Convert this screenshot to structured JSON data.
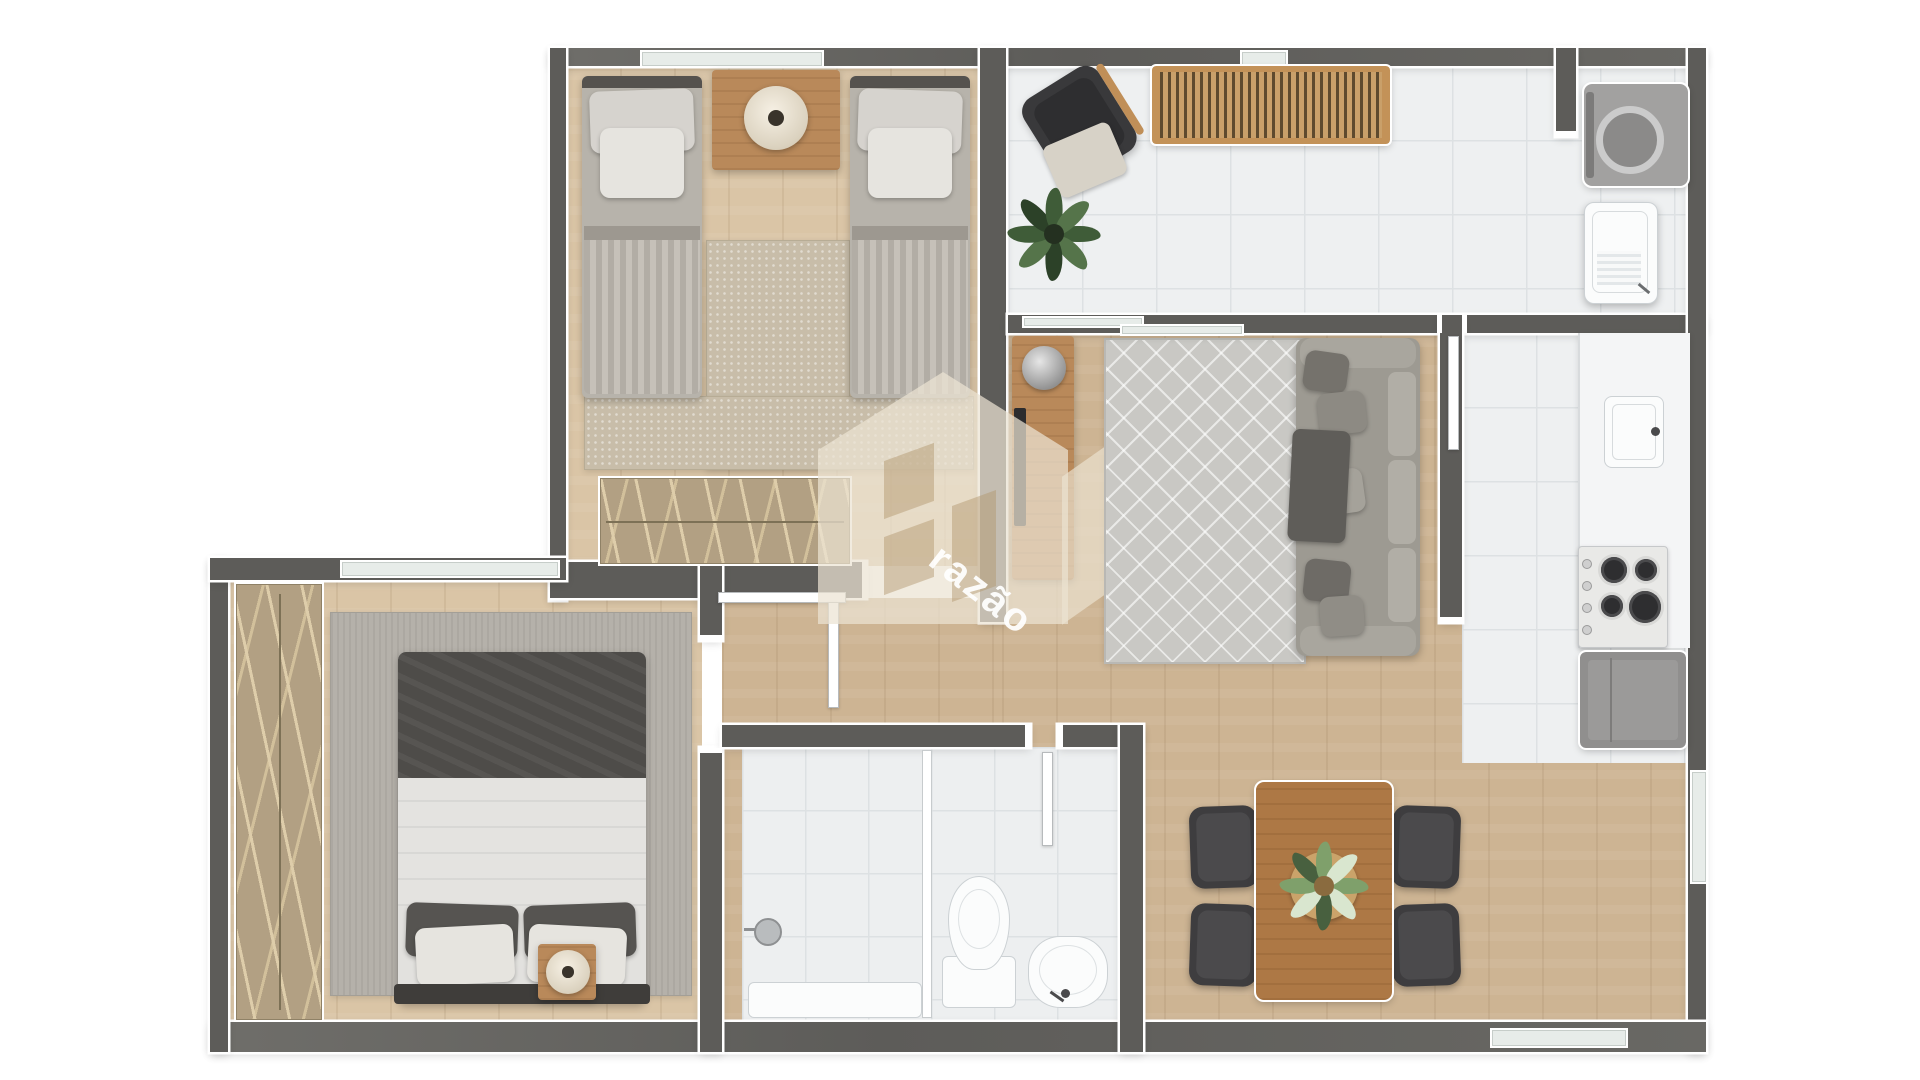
{
  "meta": {
    "type": "apartment-floor-plan-render",
    "view": "top-down",
    "background": "#ffffff"
  },
  "watermark": {
    "text": "razão",
    "logo": "house-shield-monogram",
    "color": "#ece3d2"
  },
  "palette": {
    "wall": "#5d5c59",
    "wall_outline": "#ffffff",
    "wood_floor": "#cdb493",
    "wood_floor_light": "#dac5a6",
    "tile_floor": "#eef0f1",
    "furniture_wood": "#b9895a",
    "dark_furniture": "#3e3d3f",
    "sofa_gray": "#9d9a92",
    "rug_beige": "#c8bda9",
    "rug_gray": "#b5b1aa",
    "plant_green": "#3f5c38"
  },
  "rooms": [
    {
      "id": "bedroom-twin",
      "position": "top-left",
      "furniture": [
        "twin-bed-left",
        "twin-bed-right",
        "nightstand",
        "table-lamp",
        "beige-rug",
        "wardrobe-with-hangers"
      ],
      "windows": [
        "top-wall-window"
      ]
    },
    {
      "id": "balcony-terrace",
      "position": "top-center-right",
      "floor": "white-tile",
      "furniture": [
        "lounge-armchair-with-blanket",
        "wood-slatted-bench",
        "potted-plant"
      ]
    },
    {
      "id": "laundry-area",
      "position": "top-right-corner",
      "floor": "white-tile",
      "furniture": [
        "washing-machine",
        "laundry-tank-sink"
      ]
    },
    {
      "id": "living-room",
      "position": "center",
      "furniture": [
        "tv-console",
        "tv",
        "decor-sphere",
        "patterned-rug",
        "sofa-with-pillows",
        "throw-blanket"
      ],
      "doors": [
        "sliding-glass-door-to-balcony"
      ]
    },
    {
      "id": "kitchen",
      "position": "right",
      "floor": "white-tile",
      "furniture": [
        "counter",
        "kitchen-sink",
        "gas-cooktop-4-burners",
        "refrigerator"
      ],
      "windows": [
        "right-wall-window"
      ]
    },
    {
      "id": "dining-area",
      "position": "bottom-right",
      "furniture": [
        "dining-table",
        "dining-chair x4",
        "centerpiece-plant"
      ],
      "windows": [
        "bottom-wall-window"
      ]
    },
    {
      "id": "bathroom",
      "position": "bottom-center",
      "floor": "white-tile",
      "furniture": [
        "shower-head",
        "glass-partition",
        "shower-tray",
        "toilet",
        "pedestal-sink"
      ],
      "doors": [
        "bathroom-door"
      ]
    },
    {
      "id": "bedroom-double",
      "position": "bottom-left",
      "furniture": [
        "double-bed",
        "pillows x4",
        "gray-rug",
        "wardrobe-with-hangers",
        "side-table",
        "table-lamp"
      ],
      "windows": [
        "top-wall-window"
      ],
      "doors": [
        "bedroom-door"
      ]
    }
  ],
  "counts": {
    "bedrooms": 2,
    "bathrooms": 1,
    "dining_chairs": 4,
    "twin_beds": 2,
    "plants": 3
  }
}
